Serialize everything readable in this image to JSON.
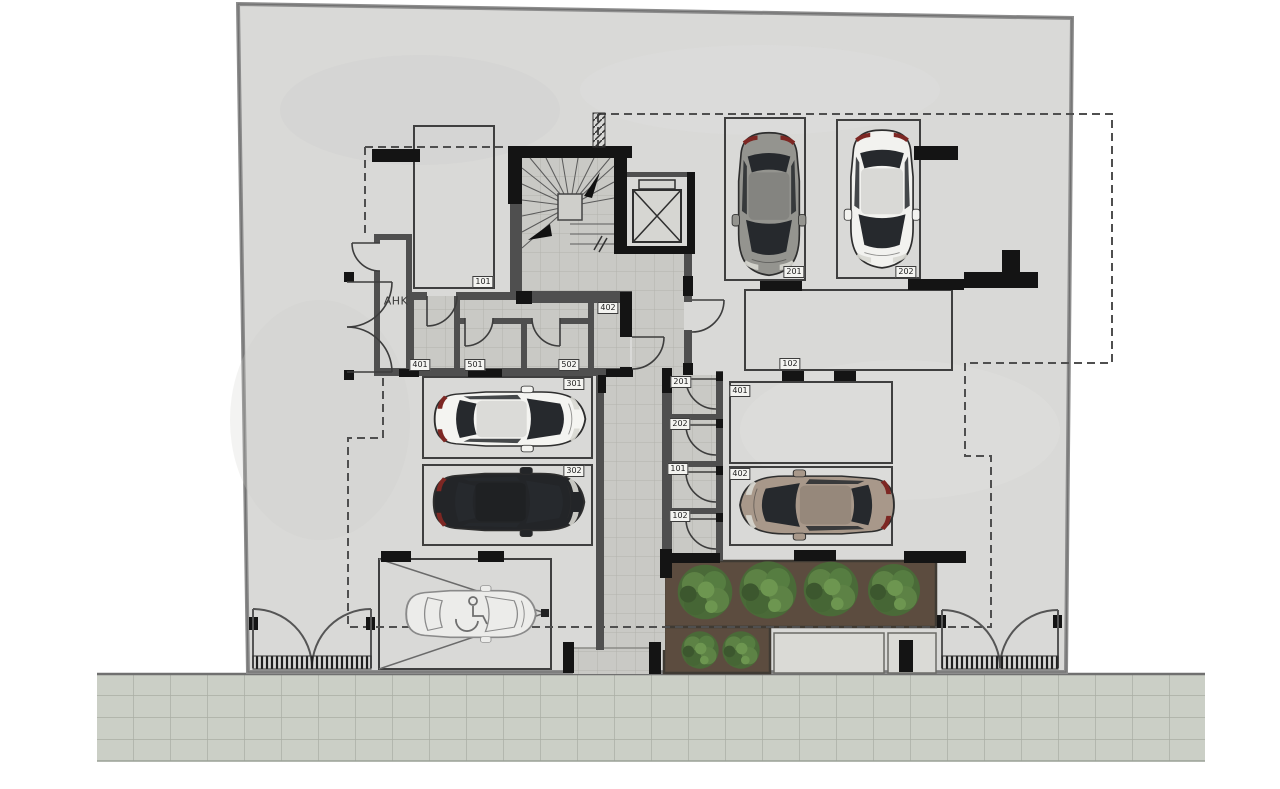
{
  "plan": {
    "kind": "architectural floor plan, ground floor parking level"
  },
  "labels": {
    "parking_101": "101",
    "parking_201": "201",
    "parking_202": "202",
    "parking_102": "102",
    "parking_301": "301",
    "parking_302": "302",
    "parking_401": "401",
    "parking_402": "402",
    "storage_401": "401",
    "storage_501": "501",
    "storage_502": "502",
    "storage_402": "402",
    "storage_201": "201",
    "storage_202": "202",
    "storage_101": "101",
    "storage_102": "102",
    "room_ahk": "AHK"
  },
  "colors": {
    "site_ground": "#d9d9d7",
    "boundary_wall": "#8d8d8d",
    "tile_floor": "#c9c9c5",
    "wall_black": "#141414",
    "wall_gray": "#4f4f4f",
    "parking_outline": "#3f3f3f",
    "dashed_line": "#4f4f4f",
    "planter_soil": "#5c4c3f",
    "plant_green": "#567d41",
    "sidewalk": "#cbcfc6"
  },
  "cars": {
    "car_201": "#94948f",
    "car_202": "#f2f2ef",
    "car_301": "#f4f4f1",
    "car_302": "#232528",
    "car_402": "#a8988a",
    "car_accessible": "#ececea"
  }
}
